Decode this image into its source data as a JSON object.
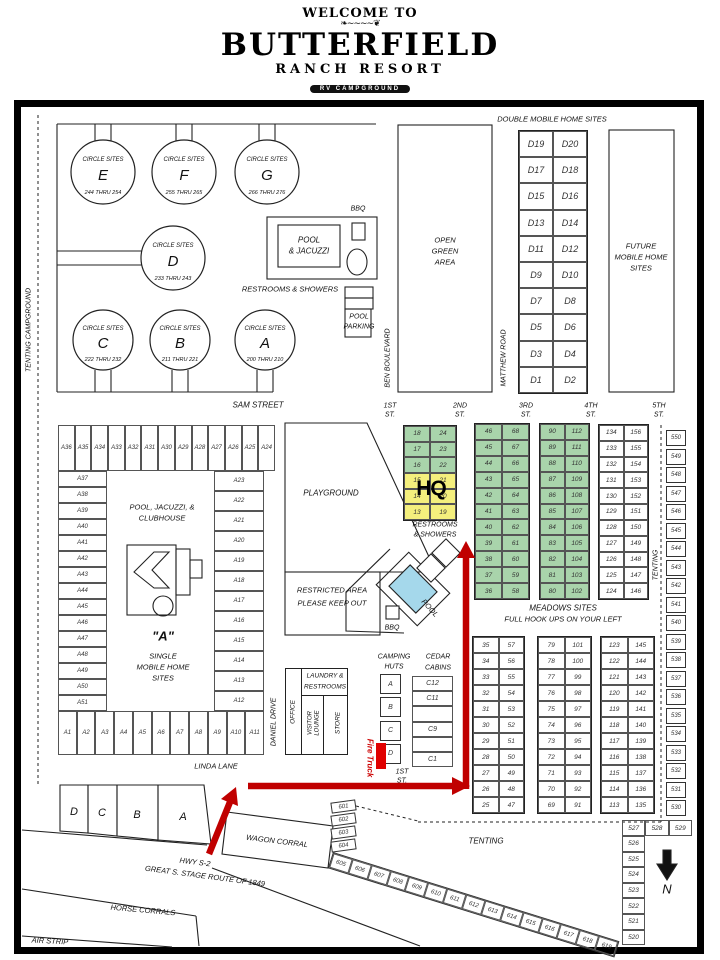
{
  "header": {
    "welcome": "WELCOME TO",
    "brand": "BUTTERFIELD",
    "brand2": "RANCH RESORT",
    "brand3": "RV CAMPGROUND",
    "address": "14925 GREAT S. OVERLAND ROUTE  ·  JULIAN, CA 92036  ·  (760) 765-1463  ·  WWW.BUTTERFIELDRESORT.COM"
  },
  "colors": {
    "green": "#a9d4ab",
    "yellow": "#f4ef7d",
    "pool_blue": "#a5d8eb",
    "arrow_red": "#c00000",
    "ink": "#222222"
  },
  "labels": {
    "double_mobile": "DOUBLE MOBILE HOME SITES",
    "future": [
      "FUTURE",
      "MOBILE HOME",
      "SITES"
    ],
    "open_green": [
      "OPEN",
      "GREEN",
      "AREA"
    ],
    "pool_jacuzzi": [
      "POOL",
      "& JACUZZI"
    ],
    "bbq": "BBQ",
    "restrooms_showers": "RESTROOMS & SHOWERS",
    "pool_parking": [
      "POOL",
      "PARKING"
    ],
    "ben": "BEN BOULEVARD",
    "matthew": "MATTHEW ROAD",
    "sam": "SAM STREET",
    "playground": "PLAYGROUND",
    "restricted": [
      "RESTRICTED AREA",
      "PLEASE KEEP OUT"
    ],
    "hq": "HQ",
    "rest2": [
      "RESTROOMS",
      "& SHOWERS"
    ],
    "pool": "POOL",
    "meadows": "MEADOWS SITES",
    "hookups": "FULL HOOK UPS ON YOUR LEFT",
    "tenting": "TENTING",
    "tenting_campground": "TENTING CAMPGROUND",
    "camping": [
      "CAMPING",
      "HUTS"
    ],
    "cedar": [
      "CEDAR",
      "CABINS"
    ],
    "laundry": [
      "LAUNDRY &",
      "RESTROOMS"
    ],
    "office": "OFFICE",
    "visitor": [
      "VISITOR",
      "LOUNGE"
    ],
    "store": "STORE",
    "daniel": "DANIEL DRIVE",
    "linda": "LINDA LANE",
    "fire": "Fire Truck",
    "first_st": [
      "1ST",
      "ST."
    ],
    "hwy": "HWY S-2",
    "stage": "GREAT S. STAGE ROUTE OF 1849",
    "wagon": "WAGON CORRAL",
    "horse": "HORSE CORRALS",
    "air": "AIR STRIP",
    "a_title": "\"A\"",
    "a_sub": [
      "SINGLE",
      "MOBILE HOME",
      "SITES"
    ],
    "pjc": [
      "POOL, JACUZZI, &",
      "CLUBHOUSE"
    ],
    "north": "N"
  },
  "streets": [
    {
      "t": "1ST",
      "s": "ST."
    },
    {
      "t": "2ND",
      "s": "ST."
    },
    {
      "t": "3RD",
      "s": "ST."
    },
    {
      "t": "4TH",
      "s": "ST."
    },
    {
      "t": "5TH",
      "s": "ST."
    }
  ],
  "circles": [
    {
      "label": "CIRCLE SITES",
      "name": "E",
      "range": "244 THRU 254"
    },
    {
      "label": "CIRCLE SITES",
      "name": "F",
      "range": "255 THRU 265"
    },
    {
      "label": "CIRCLE SITES",
      "name": "G",
      "range": "266 THRU 276"
    },
    {
      "label": "CIRCLE SITES",
      "name": "D",
      "range": "233 THRU 243"
    },
    {
      "label": "CIRCLE SITES",
      "name": "C",
      "range": "222 THRU 232"
    },
    {
      "label": "CIRCLE SITES",
      "name": "B",
      "range": "211 THRU 221"
    },
    {
      "label": "CIRCLE SITES",
      "name": "A",
      "range": "200 THRU 210"
    }
  ],
  "d_sites": [
    [
      "D19",
      "D20"
    ],
    [
      "D17",
      "D18"
    ],
    [
      "D15",
      "D16"
    ],
    [
      "D13",
      "D14"
    ],
    [
      "D11",
      "D12"
    ],
    [
      "D9",
      "D10"
    ],
    [
      "D7",
      "D8"
    ],
    [
      "D5",
      "D6"
    ],
    [
      "D3",
      "D4"
    ],
    [
      "D1",
      "D2"
    ]
  ],
  "site_grids": {
    "first": {
      "rows": [
        [
          "18",
          "24"
        ],
        [
          "17",
          "23"
        ],
        [
          "16",
          "22"
        ],
        [
          "15",
          "21"
        ],
        [
          "14",
          "20"
        ],
        [
          "13",
          "19"
        ]
      ],
      "fills": [
        "green",
        "green",
        "green",
        "yellow",
        "yellow",
        "yellow"
      ]
    },
    "second": [
      [
        "46",
        "68"
      ],
      [
        "45",
        "67"
      ],
      [
        "44",
        "66"
      ],
      [
        "43",
        "65"
      ],
      [
        "42",
        "64"
      ],
      [
        "41",
        "63"
      ],
      [
        "40",
        "62"
      ],
      [
        "39",
        "61"
      ],
      [
        "38",
        "60"
      ],
      [
        "37",
        "59"
      ],
      [
        "36",
        "58"
      ]
    ],
    "third": [
      [
        "90",
        "112"
      ],
      [
        "89",
        "111"
      ],
      [
        "88",
        "110"
      ],
      [
        "87",
        "109"
      ],
      [
        "86",
        "108"
      ],
      [
        "85",
        "107"
      ],
      [
        "84",
        "106"
      ],
      [
        "83",
        "105"
      ],
      [
        "82",
        "104"
      ],
      [
        "81",
        "103"
      ],
      [
        "80",
        "102"
      ]
    ],
    "fourth": [
      [
        "134",
        "156"
      ],
      [
        "133",
        "155"
      ],
      [
        "132",
        "154"
      ],
      [
        "131",
        "153"
      ],
      [
        "130",
        "152"
      ],
      [
        "129",
        "151"
      ],
      [
        "128",
        "150"
      ],
      [
        "127",
        "149"
      ],
      [
        "126",
        "148"
      ],
      [
        "125",
        "147"
      ],
      [
        "124",
        "146"
      ]
    ],
    "meadow1": [
      [
        "35",
        "57"
      ],
      [
        "34",
        "56"
      ],
      [
        "33",
        "55"
      ],
      [
        "32",
        "54"
      ],
      [
        "31",
        "53"
      ],
      [
        "30",
        "52"
      ],
      [
        "29",
        "51"
      ],
      [
        "28",
        "50"
      ],
      [
        "27",
        "49"
      ],
      [
        "26",
        "48"
      ],
      [
        "25",
        "47"
      ]
    ],
    "meadow2": [
      [
        "79",
        "101"
      ],
      [
        "78",
        "100"
      ],
      [
        "77",
        "99"
      ],
      [
        "76",
        "98"
      ],
      [
        "75",
        "97"
      ],
      [
        "74",
        "96"
      ],
      [
        "73",
        "95"
      ],
      [
        "72",
        "94"
      ],
      [
        "71",
        "93"
      ],
      [
        "70",
        "92"
      ],
      [
        "69",
        "91"
      ]
    ],
    "meadow3": [
      [
        "123",
        "145"
      ],
      [
        "122",
        "144"
      ],
      [
        "121",
        "143"
      ],
      [
        "120",
        "142"
      ],
      [
        "119",
        "141"
      ],
      [
        "118",
        "140"
      ],
      [
        "117",
        "139"
      ],
      [
        "116",
        "138"
      ],
      [
        "115",
        "137"
      ],
      [
        "114",
        "136"
      ],
      [
        "113",
        "135"
      ]
    ]
  },
  "fifth_street": [
    "550",
    "549",
    "548",
    "547",
    "546",
    "545",
    "544",
    "543",
    "542",
    "541",
    "540",
    "539",
    "538",
    "537",
    "536",
    "535",
    "534",
    "533",
    "532",
    "531",
    "530"
  ],
  "corner_row": [
    "527",
    "528",
    "529"
  ],
  "corner_col": [
    "526",
    "525",
    "524",
    "523",
    "522",
    "521",
    "520"
  ],
  "a_sites": {
    "top": [
      "A36",
      "A35",
      "A34",
      "A33",
      "A32",
      "A31",
      "A30",
      "A29",
      "A28",
      "A27",
      "A26",
      "A25",
      "A24"
    ],
    "left": [
      "A37",
      "A38",
      "A39",
      "A40",
      "A41",
      "A42",
      "A43",
      "A44",
      "A45",
      "A46",
      "A47",
      "A48",
      "A49",
      "A50",
      "A51"
    ],
    "right": [
      "A23",
      "A22",
      "A21",
      "A20",
      "A19",
      "A18",
      "A17",
      "A16",
      "A15",
      "A14",
      "A13",
      "A12"
    ],
    "bottom": [
      "A1",
      "A2",
      "A3",
      "A4",
      "A5",
      "A6",
      "A7",
      "A8",
      "A9",
      "A10",
      "A11"
    ]
  },
  "camping_huts": [
    "A",
    "B",
    "C",
    "D"
  ],
  "cedar_cabins": [
    "C12",
    "C11",
    "",
    "C9",
    "",
    "C1"
  ],
  "hwy_sites": [
    "601",
    "602",
    "603",
    "604"
  ],
  "tent_row": [
    "605",
    "606",
    "607",
    "608",
    "609",
    "610",
    "611",
    "612",
    "613",
    "614",
    "615",
    "616",
    "617",
    "618",
    "619"
  ],
  "entrance": [
    "D",
    "C",
    "B",
    "A"
  ]
}
